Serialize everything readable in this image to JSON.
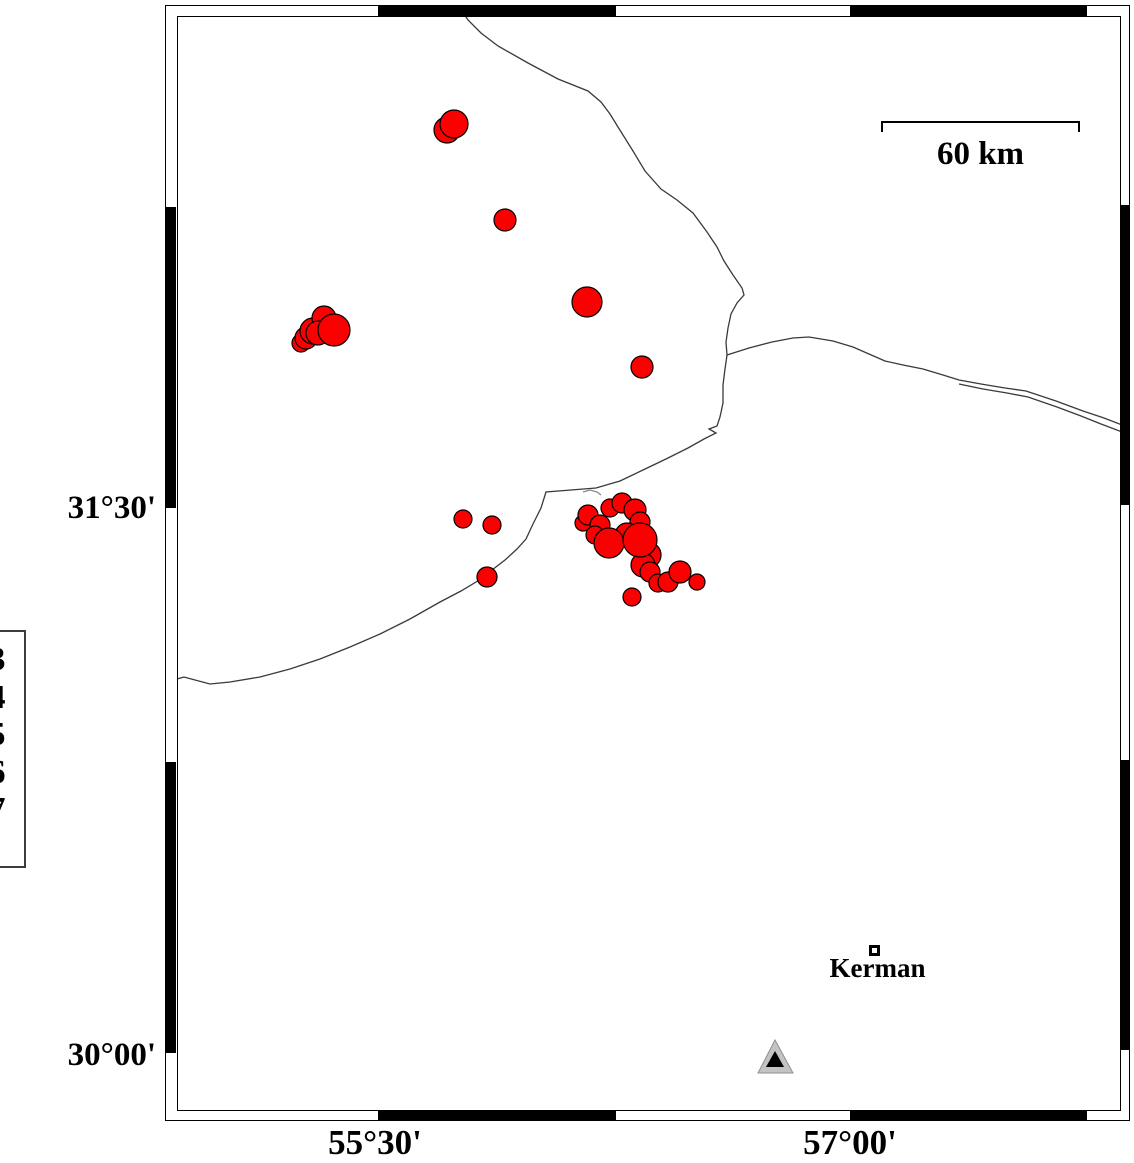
{
  "figure": {
    "kind": "seismicity-map",
    "axis": {
      "lat_ticks": [
        {
          "label": "31°30'",
          "y": 508
        },
        {
          "label": "30°00'",
          "y": 1053
        }
      ],
      "lon_ticks": [
        {
          "label": "55°30'",
          "x": 375
        },
        {
          "label": "57°00'",
          "x": 850
        }
      ]
    },
    "scale_bar": {
      "label": "60 km"
    },
    "legend": {
      "values": [
        "3",
        "4",
        "5",
        "6",
        "7"
      ]
    },
    "city": {
      "name": "Kerman",
      "x": 875,
      "y": 951
    },
    "station": {
      "shape": "triangle",
      "outer": [
        [
          775,
          1040
        ],
        [
          758,
          1073
        ],
        [
          793,
          1073
        ]
      ],
      "inner": [
        [
          775,
          1051
        ],
        [
          766,
          1067
        ],
        [
          784,
          1067
        ]
      ]
    },
    "colors": {
      "epicenter_fill": "#fb0000",
      "epicenter_stroke": "#000000",
      "fault_line": "#3a3a3a",
      "fault_line_light": "#8a8a8a",
      "triangle_gray": "#c3c3c3",
      "triangle_edge": "#909090"
    },
    "epicenters": [
      [
        447,
        130,
        13
      ],
      [
        454,
        124,
        14
      ],
      [
        505,
        220,
        11
      ],
      [
        587,
        302,
        15
      ],
      [
        642,
        367,
        11
      ],
      [
        301,
        343,
        9
      ],
      [
        306,
        338,
        11
      ],
      [
        313,
        331,
        13
      ],
      [
        324,
        318,
        12
      ],
      [
        318,
        333,
        12
      ],
      [
        334,
        330,
        16
      ],
      [
        463,
        519,
        9
      ],
      [
        492,
        525,
        9
      ],
      [
        487,
        577,
        10
      ],
      [
        583,
        523,
        8
      ],
      [
        588,
        515,
        10
      ],
      [
        610,
        508,
        9
      ],
      [
        622,
        503,
        10
      ],
      [
        635,
        510,
        11
      ],
      [
        640,
        522,
        10
      ],
      [
        600,
        525,
        10
      ],
      [
        595,
        535,
        9
      ],
      [
        627,
        535,
        12
      ],
      [
        648,
        555,
        13
      ],
      [
        643,
        565,
        12
      ],
      [
        650,
        572,
        10
      ],
      [
        658,
        583,
        9
      ],
      [
        668,
        582,
        10
      ],
      [
        680,
        572,
        11
      ],
      [
        697,
        582,
        8
      ],
      [
        632,
        597,
        9
      ],
      [
        609,
        543,
        15
      ],
      [
        640,
        540,
        17
      ]
    ],
    "faults": [
      {
        "stroke": "dark",
        "points": [
          [
            460,
            8
          ],
          [
            468,
            20
          ],
          [
            481,
            33
          ],
          [
            498,
            46
          ],
          [
            528,
            63
          ],
          [
            558,
            79
          ],
          [
            588,
            91
          ],
          [
            601,
            102
          ],
          [
            610,
            114
          ],
          [
            618,
            127
          ],
          [
            633,
            151
          ],
          [
            645,
            171
          ],
          [
            661,
            189
          ],
          [
            677,
            200
          ],
          [
            693,
            213
          ],
          [
            707,
            232
          ],
          [
            717,
            247
          ],
          [
            724,
            261
          ],
          [
            733,
            275
          ],
          [
            742,
            288
          ],
          [
            744,
            295
          ],
          [
            737,
            303
          ],
          [
            731,
            314
          ],
          [
            728,
            328
          ],
          [
            726,
            342
          ],
          [
            727,
            355
          ],
          [
            749,
            348
          ],
          [
            772,
            342
          ],
          [
            793,
            338
          ],
          [
            809,
            337
          ],
          [
            833,
            341
          ],
          [
            853,
            347
          ],
          [
            869,
            354
          ],
          [
            885,
            361
          ],
          [
            903,
            365
          ],
          [
            923,
            369
          ],
          [
            943,
            375
          ],
          [
            959,
            380
          ],
          [
            981,
            384
          ],
          [
            1005,
            388
          ],
          [
            1026,
            391
          ],
          [
            1056,
            401
          ],
          [
            1083,
            411
          ],
          [
            1104,
            418
          ],
          [
            1122,
            425
          ]
        ]
      },
      {
        "stroke": "dark",
        "points": [
          [
            959,
            384
          ],
          [
            983,
            389
          ],
          [
            1007,
            393
          ],
          [
            1028,
            397
          ],
          [
            1057,
            407
          ],
          [
            1081,
            416
          ],
          [
            1101,
            424
          ],
          [
            1122,
            432
          ]
        ]
      },
      {
        "stroke": "dark",
        "points": [
          [
            727,
            355
          ],
          [
            725,
            369
          ],
          [
            723,
            385
          ],
          [
            723,
            403
          ],
          [
            720,
            417
          ],
          [
            717,
            426
          ],
          [
            709,
            429
          ],
          [
            716,
            433
          ],
          [
            704,
            439
          ],
          [
            688,
            448
          ],
          [
            666,
            459
          ],
          [
            643,
            470
          ],
          [
            620,
            481
          ],
          [
            596,
            488
          ],
          [
            571,
            490
          ],
          [
            546,
            492
          ],
          [
            541,
            508
          ],
          [
            533,
            524
          ],
          [
            526,
            539
          ],
          [
            517,
            549
          ],
          [
            505,
            560
          ],
          [
            492,
            570
          ],
          [
            481,
            579
          ],
          [
            461,
            591
          ],
          [
            440,
            602
          ],
          [
            410,
            619
          ],
          [
            380,
            634
          ],
          [
            350,
            647
          ],
          [
            320,
            659
          ],
          [
            290,
            669
          ],
          [
            260,
            677
          ],
          [
            230,
            682
          ],
          [
            210,
            684
          ],
          [
            195,
            680
          ],
          [
            184,
            677
          ],
          [
            177,
            679
          ]
        ]
      },
      {
        "stroke": "light",
        "points": [
          [
            583,
            492
          ],
          [
            590,
            490
          ],
          [
            597,
            492
          ],
          [
            601,
            495
          ]
        ]
      }
    ],
    "frame_ticks": {
      "top": [
        {
          "x": 378,
          "w": 238
        },
        {
          "x": 850,
          "w": 237
        }
      ],
      "bottom": [
        {
          "x": 378,
          "w": 238
        },
        {
          "x": 850,
          "w": 237
        }
      ],
      "left": [
        {
          "y": 207,
          "h": 301
        },
        {
          "y": 762,
          "h": 291
        }
      ],
      "right": [
        {
          "y": 205,
          "h": 300
        },
        {
          "y": 760,
          "h": 290
        }
      ]
    }
  }
}
